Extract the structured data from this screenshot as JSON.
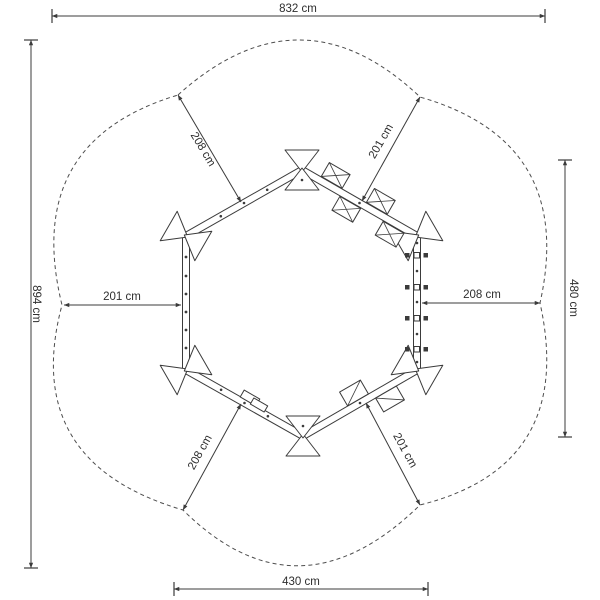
{
  "drawing": {
    "type": "top-view installation plan, hexagonal swing frame with safety zone",
    "unit": "cm"
  },
  "dimension_labels": {
    "overall_width_top": "832 cm",
    "overall_height_left": "894 cm",
    "zone_height_right": "480 cm",
    "zone_width_bottom": "430 cm",
    "clearance_top_left": "208 cm",
    "clearance_top_right": "201 cm",
    "clearance_mid_left": "201 cm",
    "clearance_mid_right": "208 cm",
    "clearance_bottom_left": "208 cm",
    "clearance_bottom_right": "201 cm"
  },
  "colors": {
    "line": "#3b3b3b",
    "boundary": "#4d4d4d",
    "text": "#2e2e2e",
    "background": "#ffffff"
  }
}
